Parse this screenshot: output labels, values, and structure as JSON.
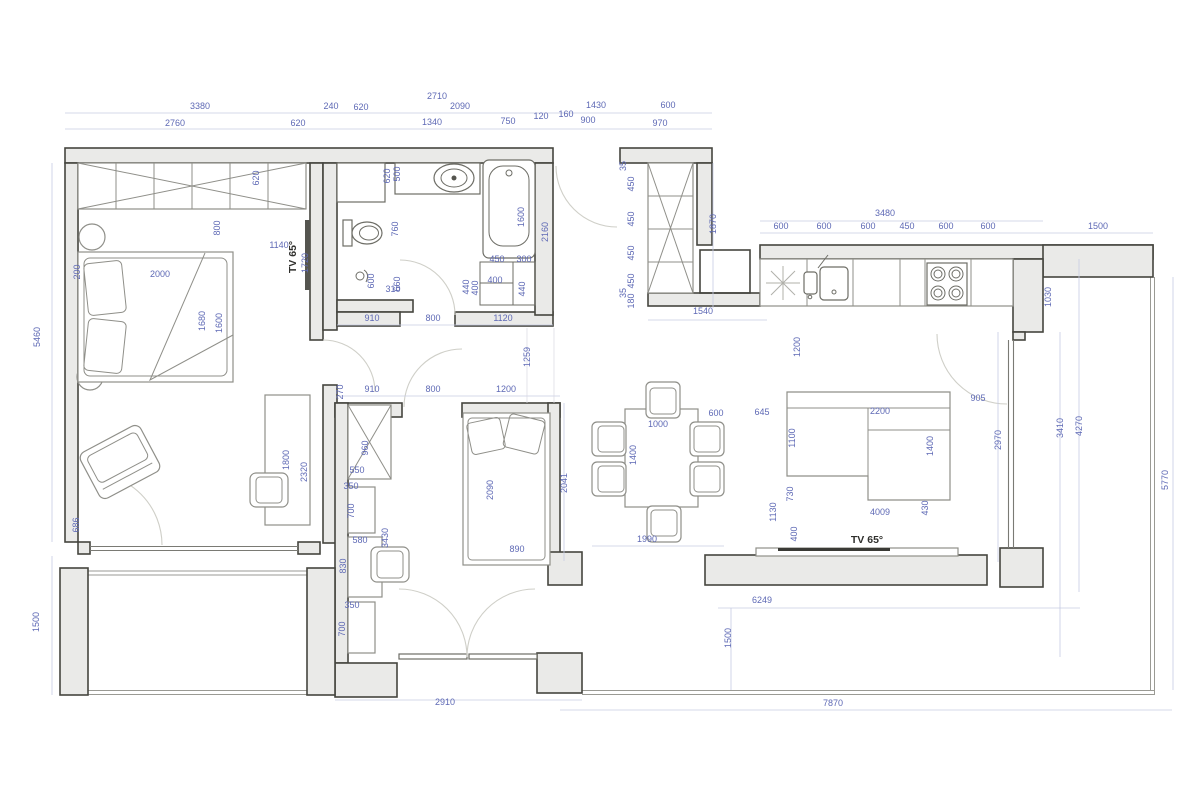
{
  "title": "Apartment floor plan with dimensions",
  "colors": {
    "wall_fill": "#eaeae8",
    "wall_stroke": "#45453f",
    "furniture": "#8f8f89",
    "fixture": "#6d6d66",
    "dim_text": "#5e69b5",
    "dim_line": "#c6cbe3"
  },
  "dimensions": [
    {
      "t": "3380",
      "x": 200,
      "y": 109,
      "r": 0
    },
    {
      "t": "2760",
      "x": 175,
      "y": 126,
      "r": 0
    },
    {
      "t": "620",
      "x": 298,
      "y": 126,
      "r": 0
    },
    {
      "t": "240",
      "x": 331,
      "y": 109,
      "r": 0
    },
    {
      "t": "620",
      "x": 361,
      "y": 110,
      "r": 0
    },
    {
      "t": "2710",
      "x": 437,
      "y": 99,
      "r": 0
    },
    {
      "t": "2090",
      "x": 460,
      "y": 109,
      "r": 0
    },
    {
      "t": "1340",
      "x": 432,
      "y": 125,
      "r": 0
    },
    {
      "t": "750",
      "x": 508,
      "y": 124,
      "r": 0
    },
    {
      "t": "120",
      "x": 541,
      "y": 119,
      "r": 0
    },
    {
      "t": "160",
      "x": 566,
      "y": 117,
      "r": 0
    },
    {
      "t": "1430",
      "x": 596,
      "y": 108,
      "r": 0
    },
    {
      "t": "900",
      "x": 588,
      "y": 123,
      "r": 0
    },
    {
      "t": "600",
      "x": 668,
      "y": 108,
      "r": 0
    },
    {
      "t": "970",
      "x": 660,
      "y": 126,
      "r": 0
    },
    {
      "t": "3480",
      "x": 885,
      "y": 216,
      "r": 0
    },
    {
      "t": "600",
      "x": 781,
      "y": 229,
      "r": 0
    },
    {
      "t": "600",
      "x": 824,
      "y": 229,
      "r": 0
    },
    {
      "t": "600",
      "x": 868,
      "y": 229,
      "r": 0
    },
    {
      "t": "450",
      "x": 907,
      "y": 229,
      "r": 0
    },
    {
      "t": "600",
      "x": 946,
      "y": 229,
      "r": 0
    },
    {
      "t": "600",
      "x": 988,
      "y": 229,
      "r": 0
    },
    {
      "t": "1500",
      "x": 1098,
      "y": 229,
      "r": 0
    },
    {
      "t": "1870",
      "x": 716,
      "y": 224,
      "r": -90
    },
    {
      "t": "1030",
      "x": 1051,
      "y": 297,
      "r": -90
    },
    {
      "t": "1540",
      "x": 703,
      "y": 314,
      "r": 0
    },
    {
      "t": "35",
      "x": 626,
      "y": 166,
      "r": -90
    },
    {
      "t": "450",
      "x": 634,
      "y": 184,
      "r": -90
    },
    {
      "t": "450",
      "x": 634,
      "y": 219,
      "r": -90
    },
    {
      "t": "450",
      "x": 634,
      "y": 253,
      "r": -90
    },
    {
      "t": "450",
      "x": 634,
      "y": 281,
      "r": -90
    },
    {
      "t": "35",
      "x": 626,
      "y": 293,
      "r": -90
    },
    {
      "t": "180",
      "x": 634,
      "y": 301,
      "r": -90
    },
    {
      "t": "620",
      "x": 390,
      "y": 176,
      "r": -90
    },
    {
      "t": "500",
      "x": 400,
      "y": 174,
      "r": -90
    },
    {
      "t": "1600",
      "x": 524,
      "y": 217,
      "r": -90
    },
    {
      "t": "2160",
      "x": 548,
      "y": 232,
      "r": -90
    },
    {
      "t": "760",
      "x": 398,
      "y": 229,
      "r": -90
    },
    {
      "t": "600",
      "x": 374,
      "y": 281,
      "r": -90
    },
    {
      "t": "660",
      "x": 400,
      "y": 284,
      "r": -90
    },
    {
      "t": "310",
      "x": 393,
      "y": 292,
      "r": 0
    },
    {
      "t": "450",
      "x": 497,
      "y": 262,
      "r": 0
    },
    {
      "t": "300",
      "x": 524,
      "y": 262,
      "r": 0
    },
    {
      "t": "400",
      "x": 495,
      "y": 283,
      "r": 0
    },
    {
      "t": "440",
      "x": 469,
      "y": 287,
      "r": -90
    },
    {
      "t": "400",
      "x": 478,
      "y": 288,
      "r": -90
    },
    {
      "t": "440",
      "x": 525,
      "y": 289,
      "r": -90
    },
    {
      "t": "910",
      "x": 372,
      "y": 321,
      "r": 0
    },
    {
      "t": "800",
      "x": 433,
      "y": 321,
      "r": 0
    },
    {
      "t": "1120",
      "x": 503,
      "y": 321,
      "r": 0
    },
    {
      "t": "620",
      "x": 259,
      "y": 178,
      "r": -90
    },
    {
      "t": "800",
      "x": 220,
      "y": 228,
      "r": -90
    },
    {
      "t": "1140",
      "x": 279,
      "y": 248,
      "r": 0
    },
    {
      "t": "TV 65°",
      "x": 296,
      "y": 257,
      "r": -90,
      "k": 1
    },
    {
      "t": "1720",
      "x": 308,
      "y": 263,
      "r": -90
    },
    {
      "t": "2000",
      "x": 160,
      "y": 277,
      "r": 0
    },
    {
      "t": "200",
      "x": 80,
      "y": 272,
      "r": -90
    },
    {
      "t": "1680",
      "x": 205,
      "y": 321,
      "r": -90
    },
    {
      "t": "1600",
      "x": 222,
      "y": 323,
      "r": -90
    },
    {
      "t": "5460",
      "x": 40,
      "y": 337,
      "r": -90
    },
    {
      "t": "686",
      "x": 79,
      "y": 525,
      "r": -90
    },
    {
      "t": "1500",
      "x": 39,
      "y": 622,
      "r": -90
    },
    {
      "t": "1800",
      "x": 289,
      "y": 460,
      "r": -90
    },
    {
      "t": "2320",
      "x": 307,
      "y": 472,
      "r": -90
    },
    {
      "t": "270",
      "x": 343,
      "y": 392,
      "r": -90
    },
    {
      "t": "910",
      "x": 372,
      "y": 392,
      "r": 0
    },
    {
      "t": "800",
      "x": 433,
      "y": 392,
      "r": 0
    },
    {
      "t": "1200",
      "x": 506,
      "y": 392,
      "r": 0
    },
    {
      "t": "1259",
      "x": 530,
      "y": 357,
      "r": -90
    },
    {
      "t": "960",
      "x": 368,
      "y": 448,
      "r": -90
    },
    {
      "t": "550",
      "x": 357,
      "y": 473,
      "r": 0
    },
    {
      "t": "350",
      "x": 351,
      "y": 489,
      "r": 0
    },
    {
      "t": "700",
      "x": 354,
      "y": 511,
      "r": -90
    },
    {
      "t": "580",
      "x": 360,
      "y": 543,
      "r": 0
    },
    {
      "t": "830",
      "x": 346,
      "y": 566,
      "r": -90
    },
    {
      "t": "3430",
      "x": 388,
      "y": 538,
      "r": -90
    },
    {
      "t": "350",
      "x": 352,
      "y": 608,
      "r": 0
    },
    {
      "t": "700",
      "x": 345,
      "y": 629,
      "r": -90
    },
    {
      "t": "2090",
      "x": 493,
      "y": 490,
      "r": -90
    },
    {
      "t": "890",
      "x": 517,
      "y": 552,
      "r": 0
    },
    {
      "t": "2041",
      "x": 567,
      "y": 483,
      "r": -90
    },
    {
      "t": "2910",
      "x": 445,
      "y": 705,
      "r": 0
    },
    {
      "t": "1000",
      "x": 658,
      "y": 427,
      "r": 0
    },
    {
      "t": "1400",
      "x": 636,
      "y": 455,
      "r": -90
    },
    {
      "t": "600",
      "x": 716,
      "y": 416,
      "r": 0
    },
    {
      "t": "645",
      "x": 762,
      "y": 415,
      "r": 0
    },
    {
      "t": "1990",
      "x": 647,
      "y": 542,
      "r": 0
    },
    {
      "t": "1130",
      "x": 776,
      "y": 512,
      "r": -90
    },
    {
      "t": "1200",
      "x": 800,
      "y": 347,
      "r": -90
    },
    {
      "t": "2200",
      "x": 880,
      "y": 414,
      "r": 0
    },
    {
      "t": "1100",
      "x": 795,
      "y": 438,
      "r": -90
    },
    {
      "t": "1400",
      "x": 933,
      "y": 446,
      "r": -90
    },
    {
      "t": "430",
      "x": 928,
      "y": 508,
      "r": -90
    },
    {
      "t": "730",
      "x": 793,
      "y": 494,
      "r": -90
    },
    {
      "t": "400",
      "x": 797,
      "y": 534,
      "r": -90
    },
    {
      "t": "4009",
      "x": 880,
      "y": 515,
      "r": 0
    },
    {
      "t": "TV 65°",
      "x": 867,
      "y": 543,
      "r": 0,
      "k": 1
    },
    {
      "t": "905",
      "x": 978,
      "y": 401,
      "r": 0
    },
    {
      "t": "2970",
      "x": 1001,
      "y": 440,
      "r": -90
    },
    {
      "t": "3410",
      "x": 1063,
      "y": 428,
      "r": -90
    },
    {
      "t": "4270",
      "x": 1082,
      "y": 426,
      "r": -90
    },
    {
      "t": "5770",
      "x": 1168,
      "y": 480,
      "r": -90
    },
    {
      "t": "6249",
      "x": 762,
      "y": 603,
      "r": 0
    },
    {
      "t": "1500",
      "x": 731,
      "y": 638,
      "r": -90
    },
    {
      "t": "7870",
      "x": 833,
      "y": 706,
      "r": 0
    }
  ]
}
